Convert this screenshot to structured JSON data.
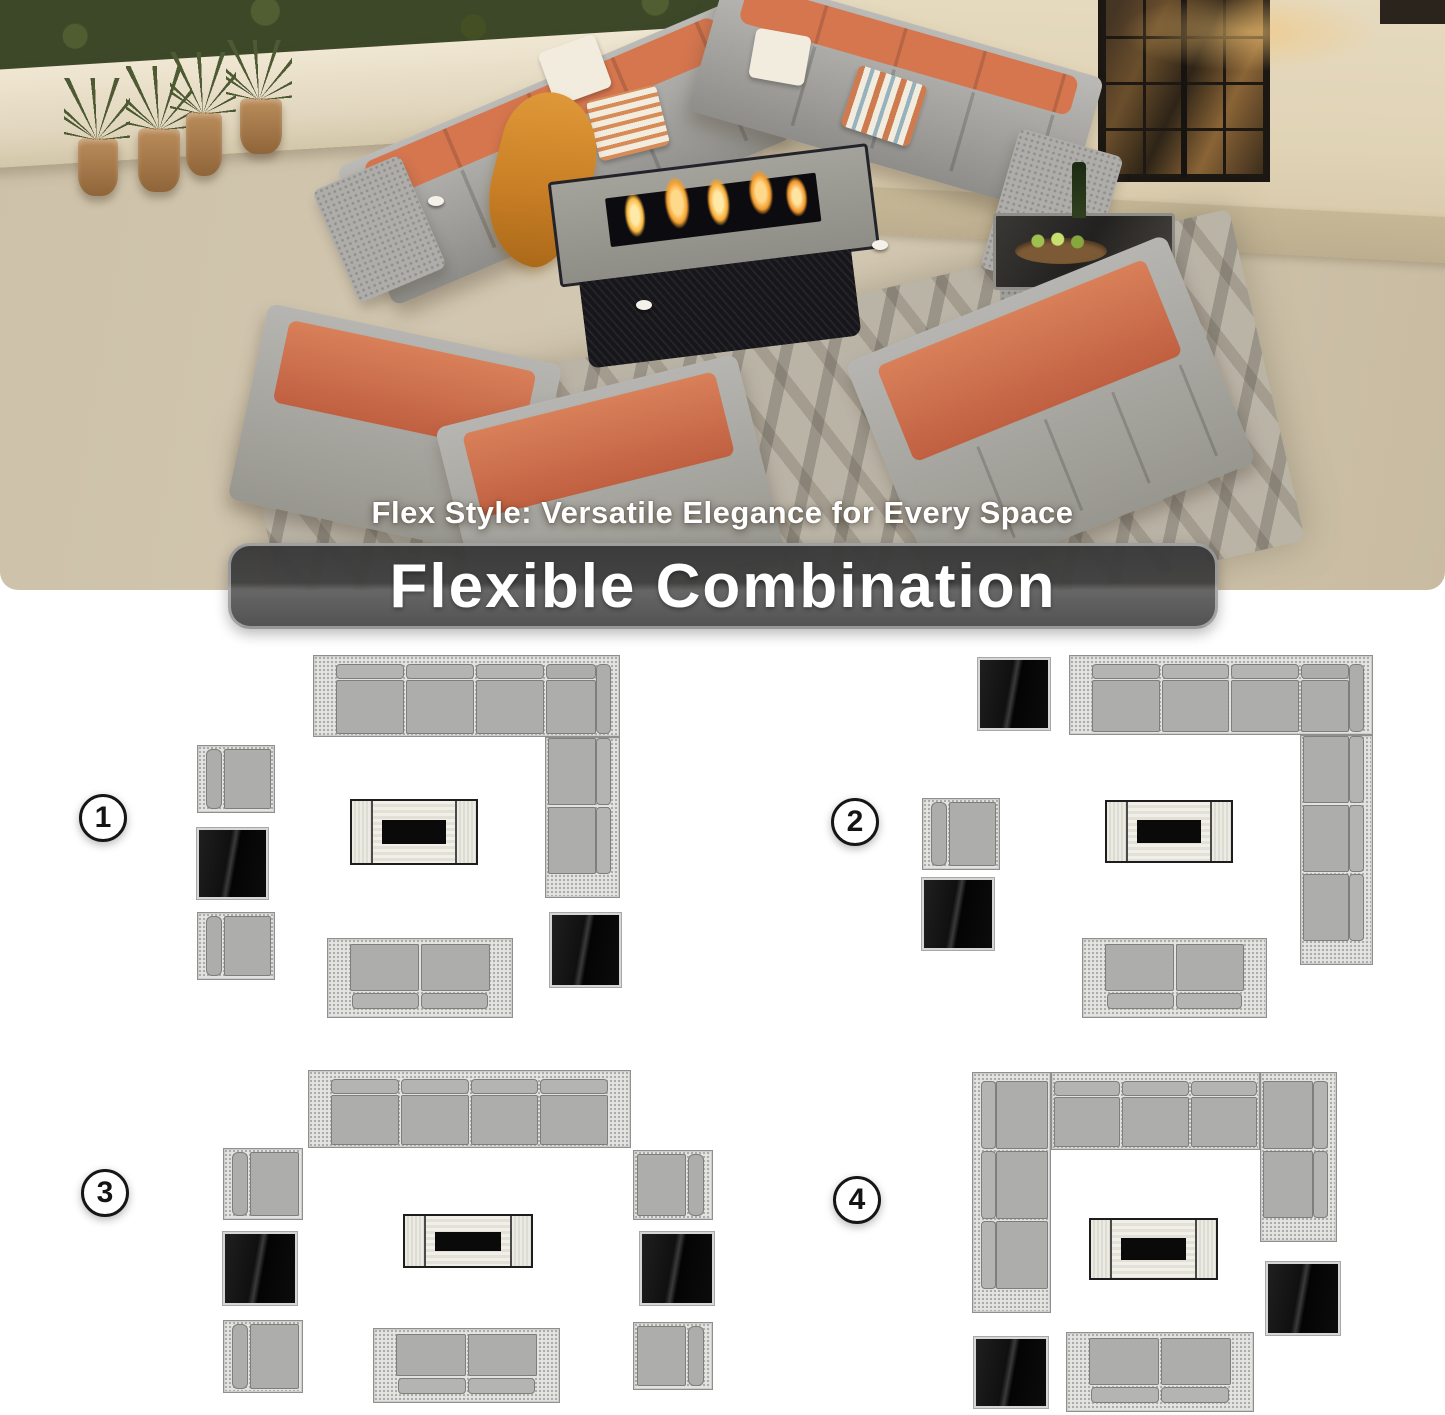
{
  "hero": {
    "caption": "Flex Style: Versatile Elegance for Every Space",
    "banner": "Flexible Combination",
    "colors": {
      "floor": "#cfc3ac",
      "wall": "#e6dabf",
      "hedge": "#3d4829",
      "door": "#241f18",
      "door_glow": "#f3c576",
      "rug": "#b6afa1",
      "wicker": "#a3a29e",
      "cushion_orange": "#cc6c48",
      "pillow": "#f2ecdf",
      "throw": "#c97f25",
      "flame": "#f5a02f",
      "fire_table_body": "#17171b",
      "side_table_glass": "#2e2c29",
      "pot": "#a87c4e",
      "plant": "#4d5a33"
    }
  },
  "diagrams": {
    "palette": {
      "wicker_fill": "#e4e4e2",
      "wicker_dot": "#a9a9a7",
      "cushion": "#adadab",
      "cushion_border": "#7e7e7c",
      "table_black": "#0c0c0c",
      "table_border": "#d6d6d4",
      "fire_wood": "#f1f0ea",
      "fire_black": "#0a0a0a",
      "outline": "#8f8f8d"
    },
    "combinations": [
      {
        "number": "1",
        "pieces": [
          {
            "name": "combination-1-badge",
            "kind": "badge",
            "x": 79,
            "y": 794,
            "w": 48,
            "h": 48
          },
          {
            "name": "corner-sofa-back-run",
            "kind": "runh",
            "x": 313,
            "y": 655,
            "w": 307,
            "h": 82,
            "opts": {
              "armLeft": true,
              "corner": 75,
              "seats": 3
            }
          },
          {
            "name": "corner-sofa-side-run",
            "kind": "runv",
            "x": 545,
            "y": 737,
            "w": 75,
            "h": 161,
            "opts": {
              "back": "right",
              "seats": 2,
              "capBottom": true
            }
          },
          {
            "name": "armless-chair",
            "kind": "chair",
            "x": 197,
            "y": 745,
            "w": 78,
            "h": 68,
            "opts": {
              "back": "left"
            }
          },
          {
            "name": "glass-side-table",
            "kind": "table",
            "x": 197,
            "y": 828,
            "w": 71,
            "h": 71
          },
          {
            "name": "armless-chair",
            "kind": "chair",
            "x": 197,
            "y": 912,
            "w": 78,
            "h": 68,
            "opts": {
              "back": "left"
            }
          },
          {
            "name": "fire-pit-table",
            "kind": "fire",
            "x": 350,
            "y": 799,
            "w": 128,
            "h": 66
          },
          {
            "name": "loveseat",
            "kind": "loveseat",
            "x": 327,
            "y": 938,
            "w": 186,
            "h": 80
          },
          {
            "name": "glass-side-table",
            "kind": "table",
            "x": 550,
            "y": 913,
            "w": 71,
            "h": 74
          }
        ]
      },
      {
        "number": "2",
        "pieces": [
          {
            "name": "combination-2-badge",
            "kind": "badge",
            "x": 831,
            "y": 798,
            "w": 48,
            "h": 48
          },
          {
            "name": "glass-side-table",
            "kind": "table",
            "x": 978,
            "y": 658,
            "w": 72,
            "h": 72
          },
          {
            "name": "corner-sofa-back-run",
            "kind": "runh",
            "x": 1069,
            "y": 655,
            "w": 304,
            "h": 80,
            "opts": {
              "armLeft": true,
              "corner": 73,
              "seats": 3
            }
          },
          {
            "name": "corner-sofa-side-run",
            "kind": "runv",
            "x": 1300,
            "y": 735,
            "w": 73,
            "h": 230,
            "opts": {
              "back": "right",
              "seats": 3,
              "capBottom": true
            }
          },
          {
            "name": "armless-chair",
            "kind": "chair",
            "x": 922,
            "y": 798,
            "w": 78,
            "h": 72,
            "opts": {
              "back": "left"
            }
          },
          {
            "name": "glass-side-table",
            "kind": "table",
            "x": 922,
            "y": 878,
            "w": 72,
            "h": 72
          },
          {
            "name": "fire-pit-table",
            "kind": "fire",
            "x": 1105,
            "y": 800,
            "w": 128,
            "h": 63
          },
          {
            "name": "loveseat",
            "kind": "loveseat",
            "x": 1082,
            "y": 938,
            "w": 185,
            "h": 80
          }
        ]
      },
      {
        "number": "3",
        "pieces": [
          {
            "name": "combination-3-badge",
            "kind": "badge",
            "x": 81,
            "y": 1169,
            "w": 48,
            "h": 48
          },
          {
            "name": "four-seat-sofa",
            "kind": "runh",
            "x": 308,
            "y": 1070,
            "w": 323,
            "h": 78,
            "opts": {
              "armLeft": true,
              "armRight": true,
              "seats": 4
            }
          },
          {
            "name": "armless-chair",
            "kind": "chair",
            "x": 223,
            "y": 1148,
            "w": 80,
            "h": 72,
            "opts": {
              "back": "left"
            }
          },
          {
            "name": "glass-side-table",
            "kind": "table",
            "x": 223,
            "y": 1232,
            "w": 74,
            "h": 73
          },
          {
            "name": "armless-chair",
            "kind": "chair",
            "x": 223,
            "y": 1320,
            "w": 80,
            "h": 73,
            "opts": {
              "back": "left"
            }
          },
          {
            "name": "armless-chair",
            "kind": "chair",
            "x": 633,
            "y": 1150,
            "w": 80,
            "h": 70,
            "opts": {
              "back": "right"
            }
          },
          {
            "name": "glass-side-table",
            "kind": "table",
            "x": 640,
            "y": 1232,
            "w": 74,
            "h": 73
          },
          {
            "name": "armless-chair",
            "kind": "chair",
            "x": 633,
            "y": 1322,
            "w": 80,
            "h": 68,
            "opts": {
              "back": "right"
            }
          },
          {
            "name": "fire-pit-table",
            "kind": "fire",
            "x": 403,
            "y": 1214,
            "w": 130,
            "h": 54
          },
          {
            "name": "loveseat",
            "kind": "loveseat",
            "x": 373,
            "y": 1328,
            "w": 187,
            "h": 75
          }
        ]
      },
      {
        "number": "4",
        "pieces": [
          {
            "name": "combination-4-badge",
            "kind": "badge",
            "x": 833,
            "y": 1176,
            "w": 48,
            "h": 48
          },
          {
            "name": "u-sectional-back-run",
            "kind": "runh",
            "x": 1051,
            "y": 1072,
            "w": 209,
            "h": 78,
            "opts": {
              "seats": 3
            }
          },
          {
            "name": "u-sectional-left-run",
            "kind": "runv",
            "x": 972,
            "y": 1072,
            "w": 79,
            "h": 241,
            "opts": {
              "back": "left",
              "seats": 3,
              "capBottom": true,
              "cornerTop": true
            }
          },
          {
            "name": "u-sectional-right-run",
            "kind": "runv",
            "x": 1260,
            "y": 1072,
            "w": 77,
            "h": 170,
            "opts": {
              "back": "right",
              "seats": 2,
              "capBottom": true,
              "cornerTop": true
            }
          },
          {
            "name": "fire-pit-table",
            "kind": "fire",
            "x": 1089,
            "y": 1218,
            "w": 129,
            "h": 62
          },
          {
            "name": "glass-side-table",
            "kind": "table",
            "x": 1266,
            "y": 1262,
            "w": 74,
            "h": 73
          },
          {
            "name": "glass-side-table",
            "kind": "table",
            "x": 974,
            "y": 1337,
            "w": 74,
            "h": 71
          },
          {
            "name": "loveseat",
            "kind": "loveseat",
            "x": 1066,
            "y": 1332,
            "w": 188,
            "h": 80
          }
        ]
      }
    ]
  }
}
